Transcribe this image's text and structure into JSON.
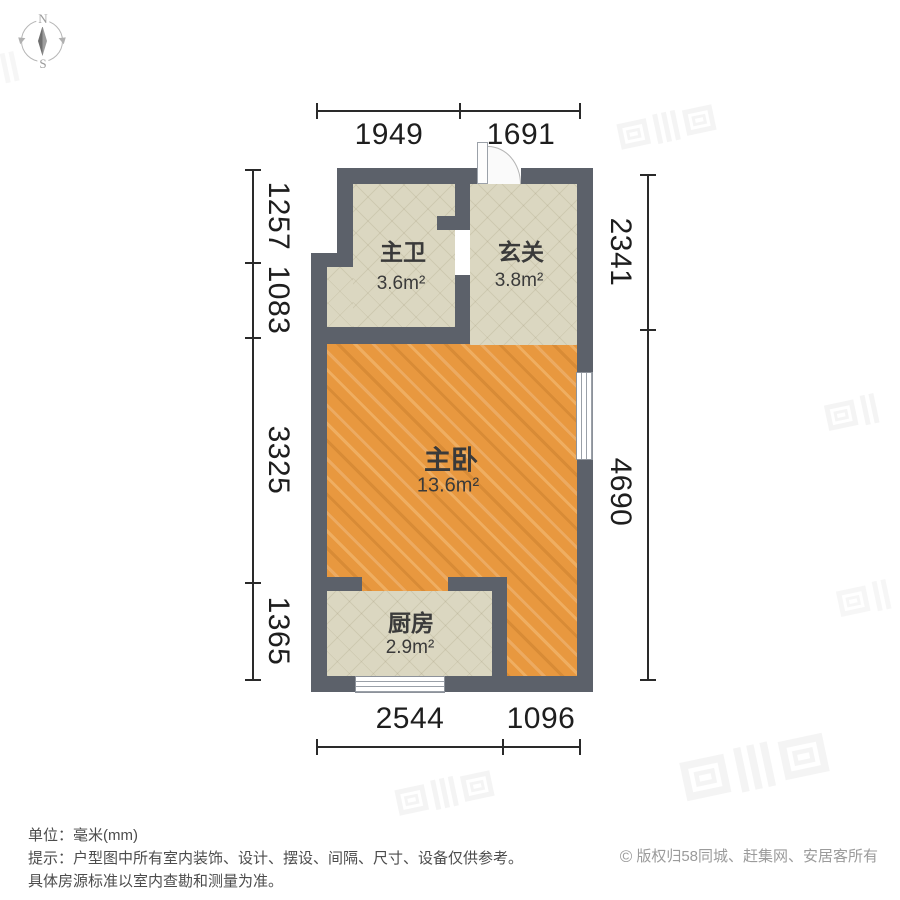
{
  "compass": {
    "north": "N",
    "south": "S"
  },
  "plan": {
    "rooms": [
      {
        "id": "bathroom",
        "name": "主卫",
        "area": "3.6m²"
      },
      {
        "id": "hall",
        "name": "玄关",
        "area": "3.8m²"
      },
      {
        "id": "bedroom",
        "name": "主卧",
        "area": "13.6m²"
      },
      {
        "id": "kitchen",
        "name": "厨房",
        "area": "2.9m²"
      }
    ],
    "dimensions": {
      "top": [
        "1949",
        "1691"
      ],
      "bottom": [
        "2544",
        "1096"
      ],
      "left": [
        "1257",
        "1083",
        "3325",
        "1365"
      ],
      "right": [
        "2341",
        "4690"
      ]
    }
  },
  "footer": {
    "unit": "单位：毫米(mm)",
    "tip": "提示：户型图中所有室内装饰、设计、摆设、间隔、尺寸、设备仅供参考。",
    "tip2": "具体房源标准以室内查勘和测量为准。",
    "copyright_symbol": "©",
    "copyright": "版权归58同城、赶集网、安居客所有"
  },
  "colors": {
    "wall": "#5c616a",
    "tile_floor": "#dbd7c1",
    "wood_floor": "#e8983f",
    "dimension_text": "#1e1e1e",
    "room_text": "#3a3a3a"
  }
}
